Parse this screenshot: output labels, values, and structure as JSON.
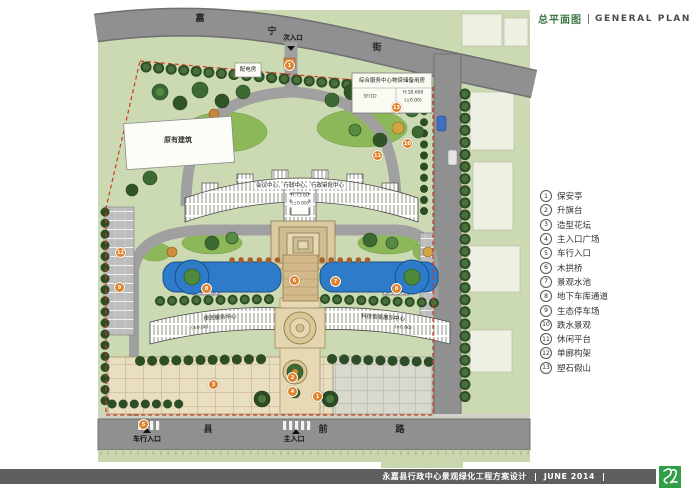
{
  "header": {
    "title_cn": "总平面图",
    "title_en": "GENERAL PLAN"
  },
  "legend": {
    "items": [
      {
        "num": "1",
        "label": "保安亭"
      },
      {
        "num": "2",
        "label": "升旗台"
      },
      {
        "num": "3",
        "label": "造型花坛"
      },
      {
        "num": "4",
        "label": "主入口广场"
      },
      {
        "num": "5",
        "label": "车行入口"
      },
      {
        "num": "6",
        "label": "木拱桥"
      },
      {
        "num": "7",
        "label": "景观水池"
      },
      {
        "num": "8",
        "label": "地下车库通道"
      },
      {
        "num": "9",
        "label": "生态停车场"
      },
      {
        "num": "10",
        "label": "跌水景观"
      },
      {
        "num": "11",
        "label": "休闲平台"
      },
      {
        "num": "12",
        "label": "单廊构架"
      },
      {
        "num": "13",
        "label": "塑石假山"
      }
    ]
  },
  "plan": {
    "streets": {
      "top_chars": [
        "嘉",
        "宁",
        "街"
      ],
      "bottom_chars": [
        "县",
        "前",
        "路"
      ]
    },
    "entrances": {
      "secondary": "次入口",
      "vehicle": "车行入口",
      "main": "主入口"
    },
    "labels": {
      "existing_building": "原有建筑",
      "power_room": "配电房",
      "main_building": "会议中心、行政中心、行政审批中心",
      "main_building_elev": "H:73.60",
      "main_building_level": "(±0.00)",
      "storage_building": "综合服务中心物资储备用房",
      "storage_floors": "5F/1D",
      "storage_elev": "H:18.600",
      "storage_level": "(±0.00)",
      "left_building": "便民服务中心",
      "left_building_level": "(±0.00)",
      "right_building": "科技信息展示中心",
      "right_building_level": "(±0.00)"
    },
    "markers": [
      {
        "n": "1",
        "x": 289,
        "y": 65
      },
      {
        "n": "13",
        "x": 396,
        "y": 107
      },
      {
        "n": "10",
        "x": 407,
        "y": 143
      },
      {
        "n": "11",
        "x": 377,
        "y": 155
      },
      {
        "n": "12",
        "x": 120,
        "y": 252
      },
      {
        "n": "9",
        "x": 119,
        "y": 287
      },
      {
        "n": "6",
        "x": 294,
        "y": 280
      },
      {
        "n": "7",
        "x": 335,
        "y": 281
      },
      {
        "n": "8",
        "x": 206,
        "y": 288
      },
      {
        "n": "8",
        "x": 396,
        "y": 288
      },
      {
        "n": "2",
        "x": 292,
        "y": 377
      },
      {
        "n": "4",
        "x": 292,
        "y": 391
      },
      {
        "n": "1",
        "x": 317,
        "y": 396
      },
      {
        "n": "3",
        "x": 213,
        "y": 384
      },
      {
        "n": "5",
        "x": 143,
        "y": 424
      }
    ]
  },
  "footer": {
    "project_title": "永嘉县行政中心景观绿化工程方案设计",
    "date": "JUNE 2014"
  },
  "colors": {
    "accent_green": "#3e7a46",
    "water_blue": "#2e7cc9",
    "context_green": "#ccdab3",
    "road_gray": "#8f8f8f",
    "boundary_red": "#cc3b1f",
    "marker_orange": "#e0832c",
    "logo_green": "#2f9e46",
    "bar_gray": "#5e5e5e"
  }
}
